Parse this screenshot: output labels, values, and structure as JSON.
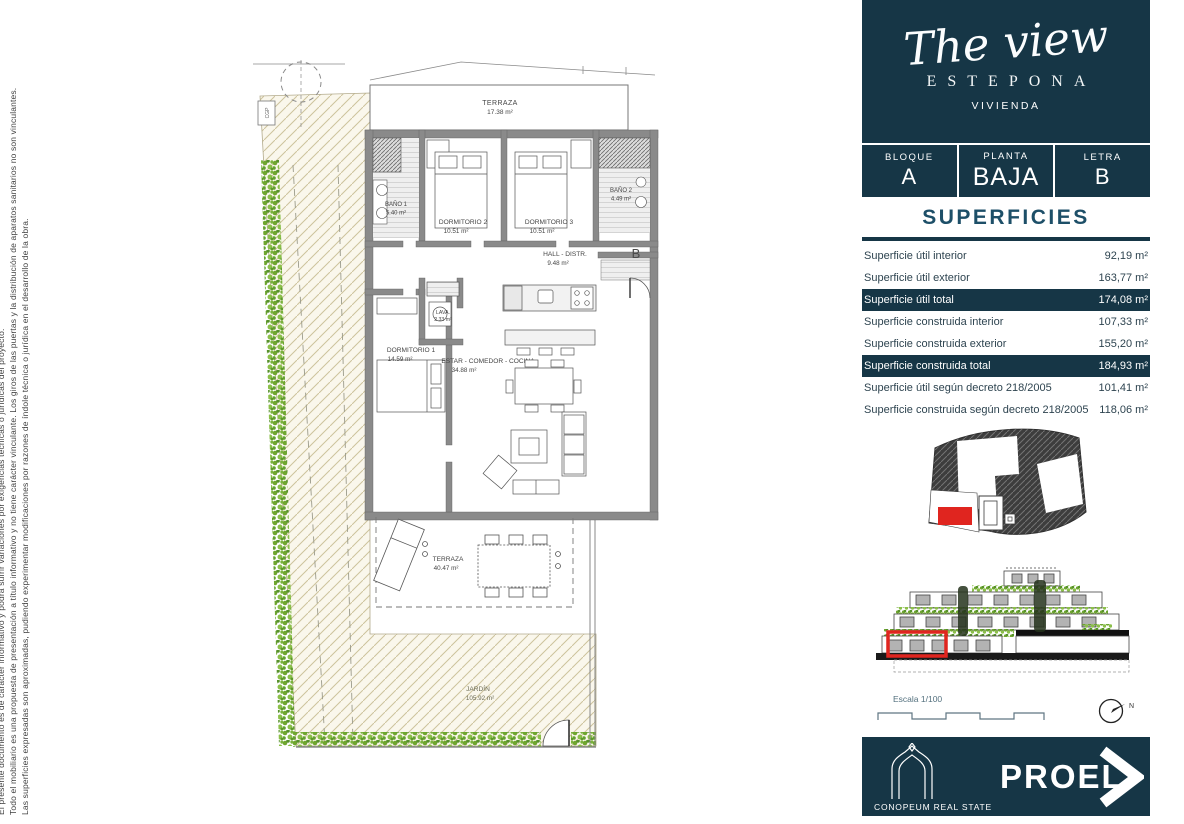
{
  "colors": {
    "navy": "#163646",
    "accent_red": "#e0251f",
    "title_teal": "#1d4f68",
    "hatch_line": "#cdc39c",
    "hedge_green": "#6fa62f",
    "wall_gray": "#8a8a8a"
  },
  "disclaimer": {
    "line1": "El presente documento es de carácter informativo y podrá sufrir variaciones por exigencias técnicas o jurídicas del proyecto.",
    "line2": "Todo el mobiliario es una propuesta de presentación a título informativo y no tiene carácter vinculante. Los giros de las puertas y la distribución de aparatos sanitarios no son vinculantes.",
    "line3": "Las superficies expresadas son aproximadas, pudiendo experimentar modificaciones por razones de índole técnica o jurídica en el desarrollo de la obra."
  },
  "brand": {
    "script": "The view",
    "city": "ESTEPONA",
    "type": "VIVIENDA"
  },
  "unit": {
    "bloque_label": "BLOQUE",
    "bloque_value": "A",
    "planta_label": "PLANTA",
    "planta_value": "BAJA",
    "letra_label": "LETRA",
    "letra_value": "B"
  },
  "superficies": {
    "title": "SUPERFICIES",
    "rows": [
      {
        "label": "Superficie útil interior",
        "value": "92,19 m²"
      },
      {
        "label": "Superficie útil exterior",
        "value": "163,77 m²"
      },
      {
        "label": "Superficie útil total",
        "value": "174,08 m²"
      },
      {
        "label": "Superficie construida interior",
        "value": "107,33 m²"
      },
      {
        "label": "Superficie construida exterior",
        "value": "155,20 m²"
      },
      {
        "label": "Superficie construida total",
        "value": "184,93 m²"
      },
      {
        "label": "Superficie útil según decreto 218/2005",
        "value": "101,41 m²"
      },
      {
        "label": "Superficie construida según decreto 218/2005",
        "value": "118,06 m²"
      }
    ]
  },
  "floorplan": {
    "terraza_top": {
      "name": "TERRAZA",
      "area": "17.38 m²"
    },
    "bano1": {
      "name": "BAÑO 1",
      "area": "5.40 m²"
    },
    "dorm2": {
      "name": "DORMITORIO 2",
      "area": "10.51 m²"
    },
    "dorm3": {
      "name": "DORMITORIO 3",
      "area": "10.51 m²"
    },
    "bano2": {
      "name": "BAÑO 2",
      "area": "4.49 m²"
    },
    "hall": {
      "name": "HALL - DISTR.",
      "area": "9.48 m²"
    },
    "lava": {
      "name": "LAVA.",
      "area": "2.33 m²"
    },
    "dorm1": {
      "name": "DORMITORIO 1",
      "area": "14.59 m²"
    },
    "estar": {
      "name": "ESTAR - COMEDOR - COCINA",
      "area": "34.88 m²"
    },
    "terraza_low": {
      "name": "TERRAZA",
      "area": "40.47 m²"
    },
    "jardin": {
      "name": "JARDÍN",
      "area": "105.92 m²"
    },
    "entrance_letter": "B",
    "cgp": "CGP"
  },
  "scalebar": {
    "label": "Escala 1/100"
  },
  "north": {
    "label": "N"
  },
  "footer": {
    "company": "CONOPEUM REAL STATE",
    "brand": "PROEL"
  },
  "icons": {
    "chevron": "chevron-right",
    "north_arrow": "compass-needle",
    "arch": "arch-logo"
  }
}
